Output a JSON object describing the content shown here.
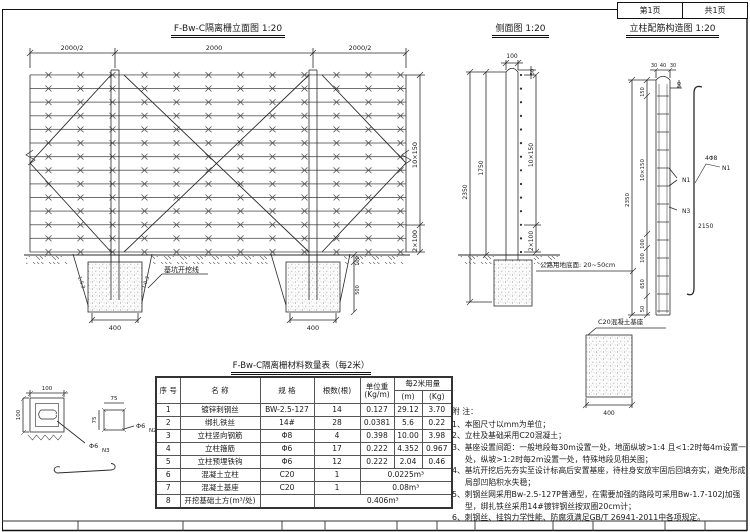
{
  "page": {
    "sheet_no": "第1页",
    "sheet_total": "共1页"
  },
  "elevation": {
    "title": "F-Bw-C隔离栅立面图  1:20",
    "dims": {
      "span_left": "2000/2",
      "span_mid": "2000",
      "span_right": "2000/2",
      "wires_upper": "10×150",
      "wires_lower": "2×100",
      "base_width_1": "400",
      "base_width_2": "400",
      "f2_top": "100",
      "f2_depth": "500",
      "slope_left": "1:0.3",
      "slope_right": "1:0.3"
    },
    "labels": {
      "excavation": "基坑开挖线"
    }
  },
  "side_view": {
    "title": "侧面图  1:20",
    "dims": {
      "post_width": "100",
      "top_offset": "50",
      "above_ground": "1750",
      "total_height": "2350",
      "wires_upper": "10×150",
      "wires_lower": "2×100"
    },
    "labels": {
      "row_boundary": "公路用地底面: 20~50cm"
    }
  },
  "rebar": {
    "title": "立柱配筋构造图  1:20",
    "dims": {
      "cover_left": "30",
      "core": "40",
      "cover_right": "30",
      "top_offset": "50",
      "seg_top": "150",
      "seg_main": "10×150",
      "total": "2350",
      "seg_b1": "100",
      "seg_b2": "100",
      "seg_b3": "650",
      "seg_b4": "50",
      "bar_length": "2150",
      "base_width": "400"
    },
    "labels": {
      "mark_n1": "N1",
      "mark_n3": "N3",
      "bar_spec": "4Φ8",
      "bar_mark": "N1",
      "base": "C20混凝土基座"
    }
  },
  "details": {
    "section": {
      "width": "100",
      "height": "100",
      "bar": "Φ6",
      "mark": "N3"
    },
    "stirrup": {
      "width": "75",
      "height": "75",
      "bar": "Φ6",
      "mark": "N2"
    }
  },
  "table": {
    "title": "F-Bw-C隔离栅材料数量表（每2米）",
    "headers": {
      "no": "序 号",
      "name": "名  称",
      "spec": "规  格",
      "qty": "根数(根)",
      "unit_weight_1": "单位重",
      "unit_weight_2": "(Kg/m)",
      "usage": "每2米用量",
      "usage_m": "(m)",
      "usage_kg": "(Kg)"
    },
    "rows": [
      {
        "no": "1",
        "name": "镀锌刺钢丝",
        "spec": "BW-2.5-127",
        "qty": "14",
        "unit": "0.127",
        "m": "29.12",
        "kg": "3.70"
      },
      {
        "no": "2",
        "name": "绑扎铁丝",
        "spec": "14#",
        "qty": "28",
        "unit": "0.0381",
        "m": "5.6",
        "kg": "0.22"
      },
      {
        "no": "3",
        "name": "立柱竖向钢筋",
        "spec": "Φ8",
        "qty": "4",
        "unit": "0.398",
        "m": "10.00",
        "kg": "3.98"
      },
      {
        "no": "4",
        "name": "立柱箍筋",
        "spec": "Φ6",
        "qty": "17",
        "unit": "0.222",
        "m": "4.352",
        "kg": "0.967"
      },
      {
        "no": "5",
        "name": "立柱预埋铁钩",
        "spec": "Φ6",
        "qty": "12",
        "unit": "0.222",
        "m": "2.04",
        "kg": "0.46"
      },
      {
        "no": "6",
        "name": "混凝土立柱",
        "spec": "C20",
        "qty": "1",
        "merged": "0.0225m³"
      },
      {
        "no": "7",
        "name": "混凝土基座",
        "spec": "C20",
        "qty": "1",
        "merged": "0.08m³"
      },
      {
        "no": "8",
        "name": "开挖基础土方(m³/处)",
        "spec": "",
        "merged": "0.406m³"
      }
    ]
  },
  "notes": {
    "heading": "附 注：",
    "items": [
      "1、本图尺寸以mm为单位；",
      "2、立柱及基础采用C20混凝土；",
      "3、基座设置间距：一般地段每30m设置一处，地面纵坡>1:4 且<1:2时每4m设置一处，纵坡>1:2时每2m设置一处，特殊地段见相关图；",
      "4、基坑开挖后先夯实至设计标高后安置基座，待柱身安放牢固后回填夯实，避免形成局部凹陷积水失稳；",
      "5、刺钢丝网采用Bw-2.5-127P普通型，在需要加强的路段可采用Bw-1.7-102J加强型，绑扎铁丝采用14#镀锌钢丝按双圈20cm计；",
      "6、刺钢丝、挂钩力学性能、防腐须满足GB/T 26941-2011中各项规定。"
    ]
  }
}
